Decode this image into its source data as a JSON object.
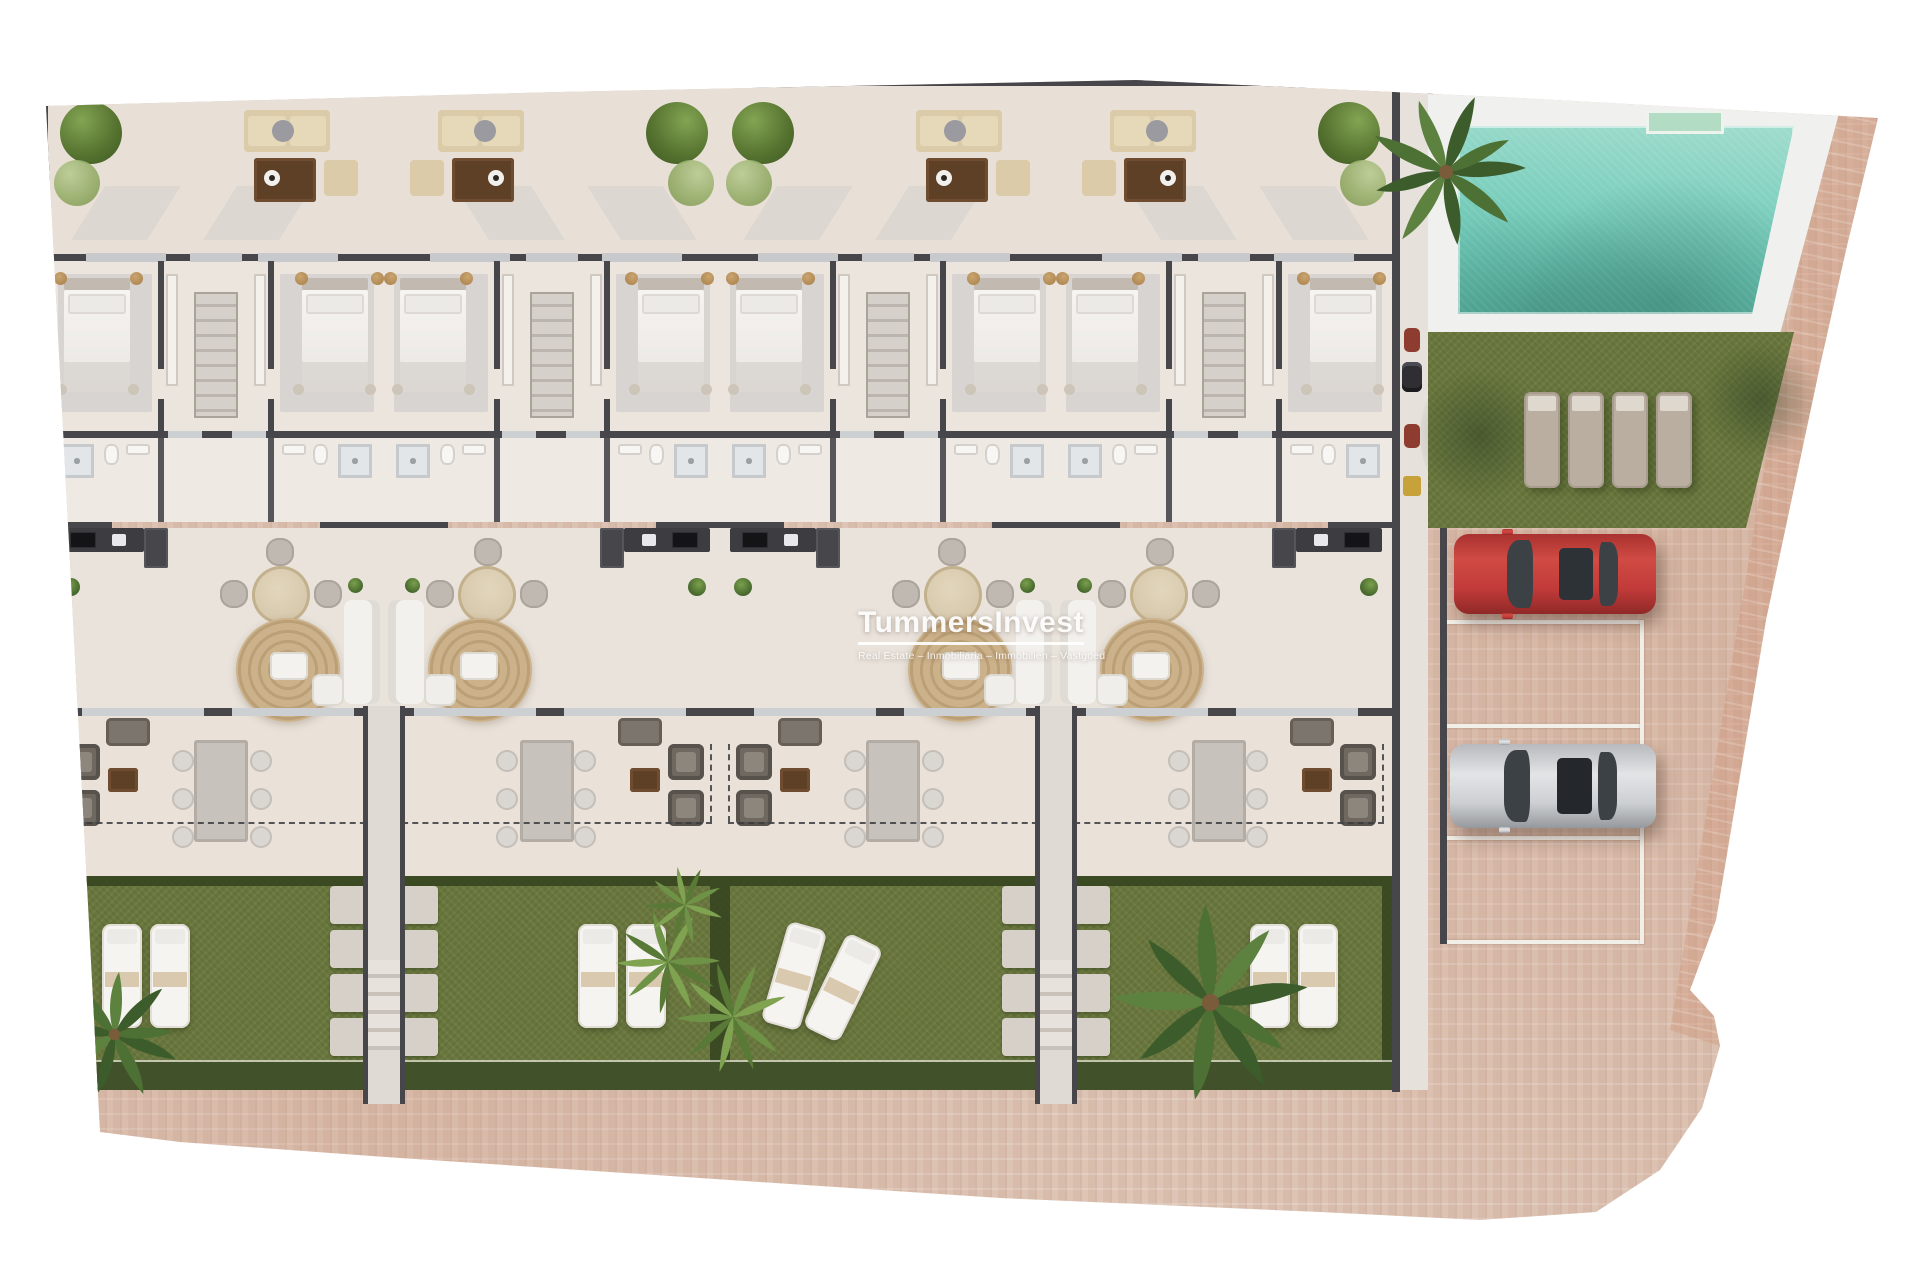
{
  "watermark": {
    "title": "TummersInvest",
    "subtitle": "Real Estate – Inmobiliaria – Immobilien – Vastgoed"
  },
  "site": {
    "description": "Top-down 3D architectural site plan: four mirrored two-bedroom townhouses with roof terraces, ground-floor terraces and private gardens, plus communal swimming pool, sunbathing lawn and private parking",
    "units": [
      {
        "id": 1,
        "label": "Townhouse 1",
        "mirrored": false,
        "garden": "loungers"
      },
      {
        "id": 2,
        "label": "Townhouse 2",
        "mirrored": true,
        "garden": "loungers"
      },
      {
        "id": 3,
        "label": "Townhouse 3",
        "mirrored": false,
        "garden": "angled-loungers-shrubs"
      },
      {
        "id": 4,
        "label": "Townhouse 4",
        "mirrored": true,
        "garden": "loungers-palm"
      }
    ],
    "pool": {
      "feature": "communal-swimming-pool",
      "water_color": "#7fd0bf",
      "deck_color": "#f0f1ee",
      "entry_steps": true
    },
    "lawn": {
      "feature": "sunbathing-lawn",
      "sun_loungers": 4
    },
    "parking": {
      "spaces": 4,
      "line_color": "#f2efe9",
      "cars": [
        {
          "name": "red-car",
          "color_key": "red",
          "space_index": 1
        },
        {
          "name": "silver-car",
          "color_key": "silver",
          "space_index": 3
        }
      ]
    },
    "vegetation": {
      "palm_trees": 3,
      "shrub_clusters": 1,
      "terrace_bushes_per_unit": 2
    }
  },
  "colors": {
    "canvas": "#ffffff",
    "paving": "#dcc2b2",
    "wall": "#47474b",
    "floor": "#e9e3db",
    "grass": "#69773d",
    "grass_border": "#41512a",
    "pool_water": "#7fd0bf",
    "rug": "#c9b08c",
    "sofa_beige": "#dbcba8",
    "wood_brown": "#5e4027",
    "red_car": "#c23b3a",
    "silver_car": "#d3d4d6"
  }
}
